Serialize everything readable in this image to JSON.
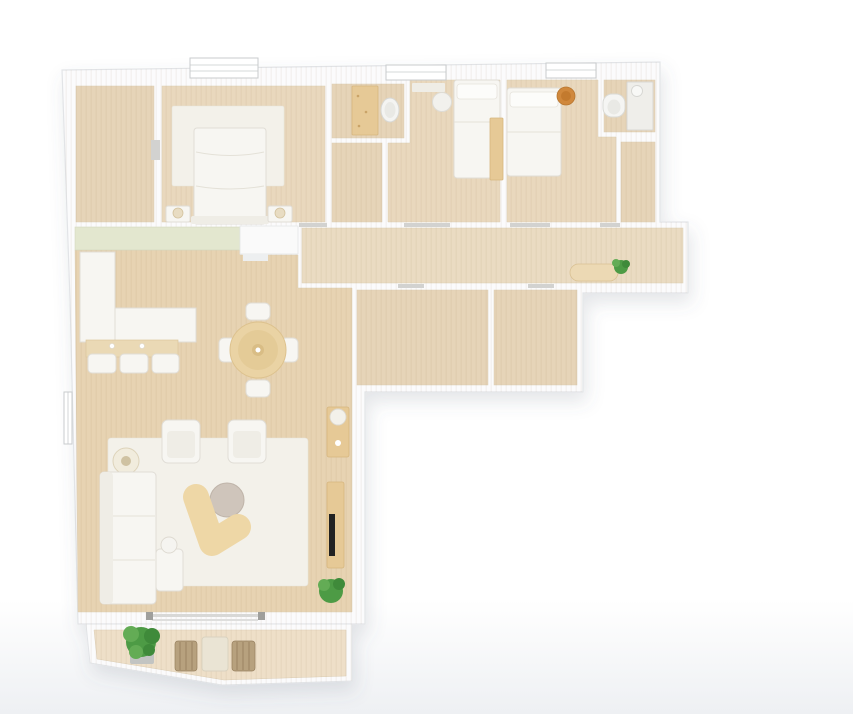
{
  "scene": {
    "kind": "rendered-top-down-floor-plan",
    "description": "3D rendered top view of an apartment: three bedrooms and bathrooms along the top, a corridor, an open kitchen / dining / living area on the left, and a terrace at the bottom. No text labels are visible in the image."
  },
  "colors": {
    "background": "#ffffff",
    "background_fade": "#eef0f3",
    "wall": "#fbfbfc",
    "wall_edge": "#e2e4e7",
    "floor_bedroom": "#e9d8bd",
    "floor_living": "#e7d3b2",
    "floor_corridor": "#eadbc2",
    "floor_terrace": "#eedfc8",
    "floor_small": "#e6d4b8",
    "rug": "#f3f1ea",
    "white_furniture": "#f7f6f2",
    "furniture_shadow": "#e0ddd6",
    "wood_furniture": "#e6c996",
    "wood_dark": "#d6b67f",
    "table_beige": "#ead3a4",
    "kidney_table": "#eed7a6",
    "coffee_table": "#cfc5bb",
    "bar_counter": "#ead9b5",
    "green_closet": "#e3e7cf",
    "plant_green": "#4d9b45",
    "plant_green_light": "#63ac55",
    "plant_green_dark": "#3f8a3a",
    "accent_orange": "#d0883c",
    "tv_black": "#222222",
    "wicker": "#b7a17e",
    "threshold_gray": "#d2d2d0",
    "pot_gray": "#c2c4c2"
  },
  "rooms": [
    {
      "id": "storage-room",
      "furniture": []
    },
    {
      "id": "master-bedroom",
      "furniture": [
        "window",
        "area-rug",
        "double-bed",
        "nightstand-left",
        "table-lamp-left",
        "nightstand-right",
        "table-lamp-right"
      ]
    },
    {
      "id": "bathroom-1",
      "furniture": [
        "wood-vanity",
        "washbasin"
      ]
    },
    {
      "id": "closet-1",
      "furniture": []
    },
    {
      "id": "bedroom-2",
      "furniture": [
        "window",
        "wall-shelf",
        "single-bed",
        "round-stool",
        "wardrobe"
      ]
    },
    {
      "id": "bedroom-3",
      "furniture": [
        "window",
        "single-bed",
        "orange-round-chair"
      ]
    },
    {
      "id": "bathroom-2",
      "furniture": [
        "toilet",
        "tall-cabinet",
        "small-washbasin"
      ]
    },
    {
      "id": "closet-2",
      "furniture": []
    },
    {
      "id": "corridor",
      "furniture": [
        "entry-closet-green",
        "entry-door-block",
        "bench",
        "small-plant"
      ]
    },
    {
      "id": "bathroom-3",
      "furniture": []
    },
    {
      "id": "bathroom-4",
      "furniture": []
    },
    {
      "id": "kitchen",
      "furniture": [
        "l-shaped-counter",
        "breakfast-bar",
        "bar-stool-1",
        "bar-stool-2",
        "bar-stool-3"
      ]
    },
    {
      "id": "dining-area",
      "furniture": [
        "round-dining-table",
        "dining-chair-north",
        "dining-chair-south",
        "dining-chair-west",
        "dining-chair-east"
      ]
    },
    {
      "id": "living-room",
      "furniture": [
        "floor-lamp",
        "l-shaped-sofa",
        "armchair-left",
        "armchair-right",
        "area-rug",
        "coffee-table-round",
        "curved-side-table",
        "small-side-table",
        "desk",
        "desk-chair",
        "tv-console",
        "tv",
        "plant",
        "sliding-door"
      ]
    },
    {
      "id": "terrace",
      "furniture": [
        "large-potted-plant",
        "outdoor-table",
        "outdoor-chair-left",
        "outdoor-chair-right"
      ]
    }
  ]
}
